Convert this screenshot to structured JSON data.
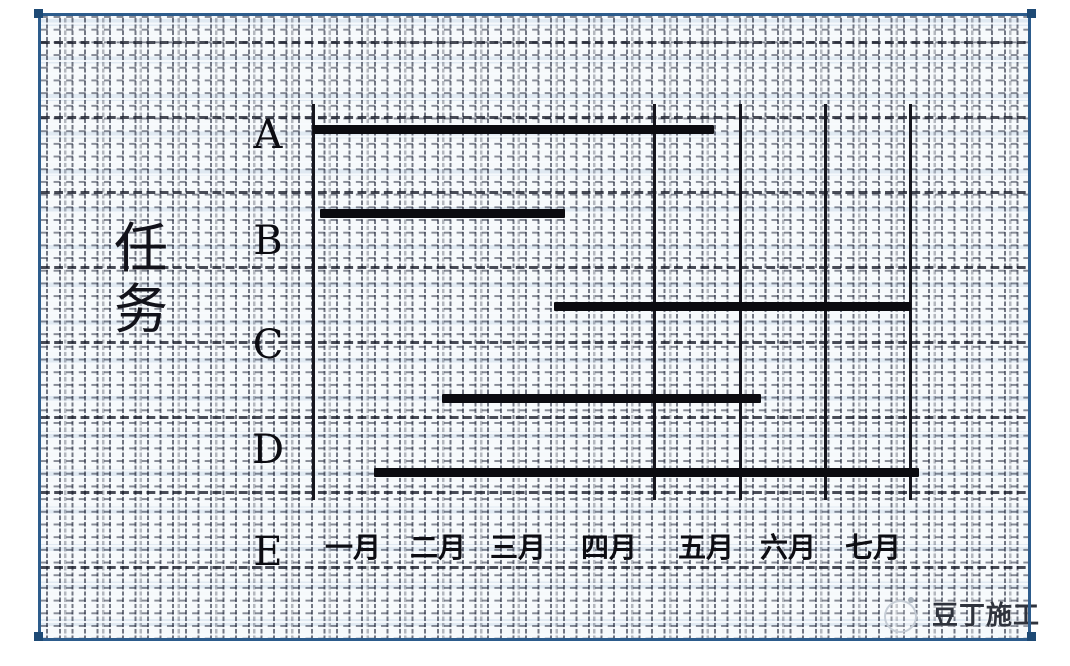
{
  "frame": {
    "border_color": "#2d5c8c"
  },
  "watermark": {
    "text": "豆丁施工",
    "logo": "docin-circle-logo"
  },
  "chart_data": {
    "type": "bar",
    "variant": "gantt",
    "title": "",
    "xlabel": "",
    "ylabel": "任务",
    "categories": [
      "A",
      "B",
      "C",
      "D",
      "E"
    ],
    "x_tick_labels": [
      "一月",
      "二月",
      "三月",
      "四月",
      "五月",
      "六月",
      "七月"
    ],
    "x_axis_unit": "month",
    "xlim_months": [
      0,
      7
    ],
    "bars": [
      {
        "task": "A",
        "start_month": 0.0,
        "end_month": 4.7
      },
      {
        "task": "B",
        "start_month": 0.08,
        "end_month": 2.95
      },
      {
        "task": "C",
        "start_month": 2.82,
        "end_month": 7.0
      },
      {
        "task": "D",
        "start_month": 1.51,
        "end_month": 5.25
      },
      {
        "task": "E",
        "start_month": 0.72,
        "end_month": 7.1
      }
    ],
    "vertical_gridlines_months": [
      0,
      4,
      5,
      6,
      7
    ],
    "grid_on": true,
    "legend": "none",
    "bar_color": "#0b0b10",
    "line_color": "#16161e",
    "geometry": {
      "x0_px": 313,
      "month_width_px": 85.4,
      "plot_top_px": 104,
      "plot_bottom_px": 500,
      "rows": [
        {
          "task": "A",
          "bar_y_px": 129,
          "label_y_px": 135
        },
        {
          "task": "B",
          "bar_y_px": 213,
          "label_y_px": 241
        },
        {
          "task": "C",
          "bar_y_px": 306,
          "label_y_px": 345
        },
        {
          "task": "D",
          "bar_y_px": 398,
          "label_y_px": 450
        },
        {
          "task": "E",
          "bar_y_px": 472,
          "label_y_px": 552
        }
      ],
      "tick_centers_px": [
        353,
        438,
        518,
        609,
        706,
        788,
        873
      ],
      "tick_y_px": 548,
      "row_label_x_px": 268
    }
  }
}
